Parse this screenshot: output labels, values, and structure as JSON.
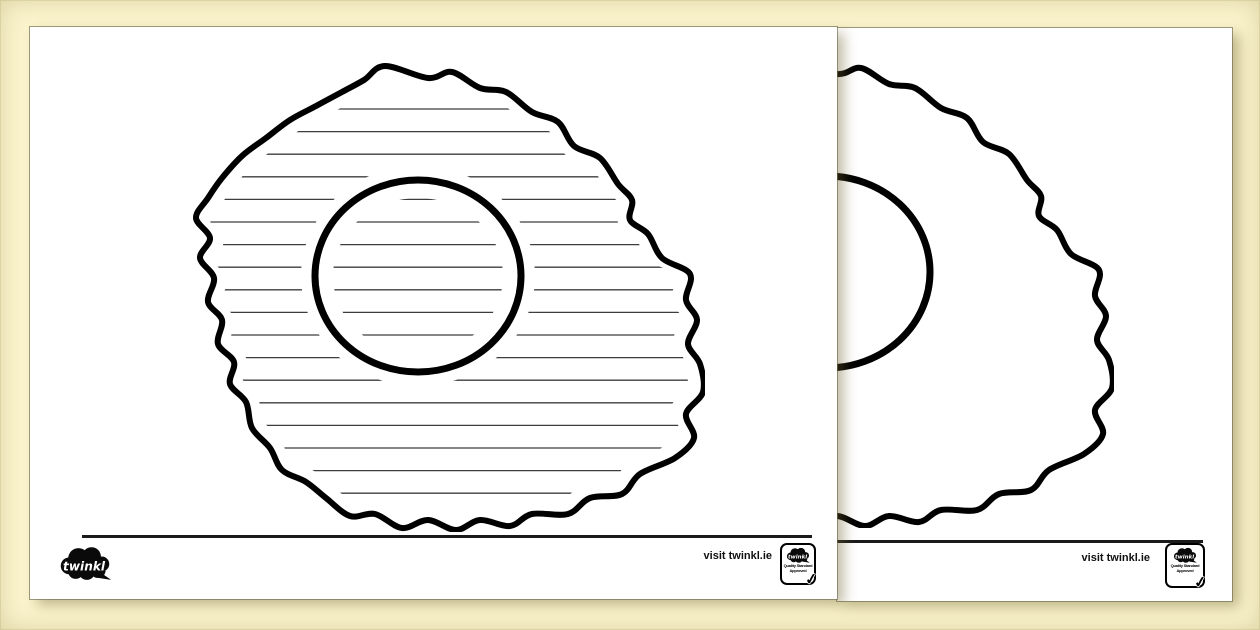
{
  "document": {
    "kind": "printable-writing-frame-preview",
    "subject_shape": "fried egg with yolk",
    "page_count_visible": 2
  },
  "brand": {
    "logo_text": "twinkl",
    "visit_text": "visit twinkl.ie",
    "badge": {
      "logo_text": "twinkl",
      "approval_line1": "Quality Standard",
      "approval_line2": "Approved",
      "check_glyph": "✓"
    }
  },
  "colors": {
    "background": "#FBF4CD",
    "page": "#FFFFFF",
    "egg_outline": "#000000",
    "writing_line": "#3D3D3D",
    "footer_rule": "#1A1A1A"
  },
  "egg_frame": {
    "front_has_lines": true,
    "back_has_lines": false,
    "writing_line_count": 18,
    "writing_line_first_y": 47,
    "writing_line_spacing": 22.6
  }
}
